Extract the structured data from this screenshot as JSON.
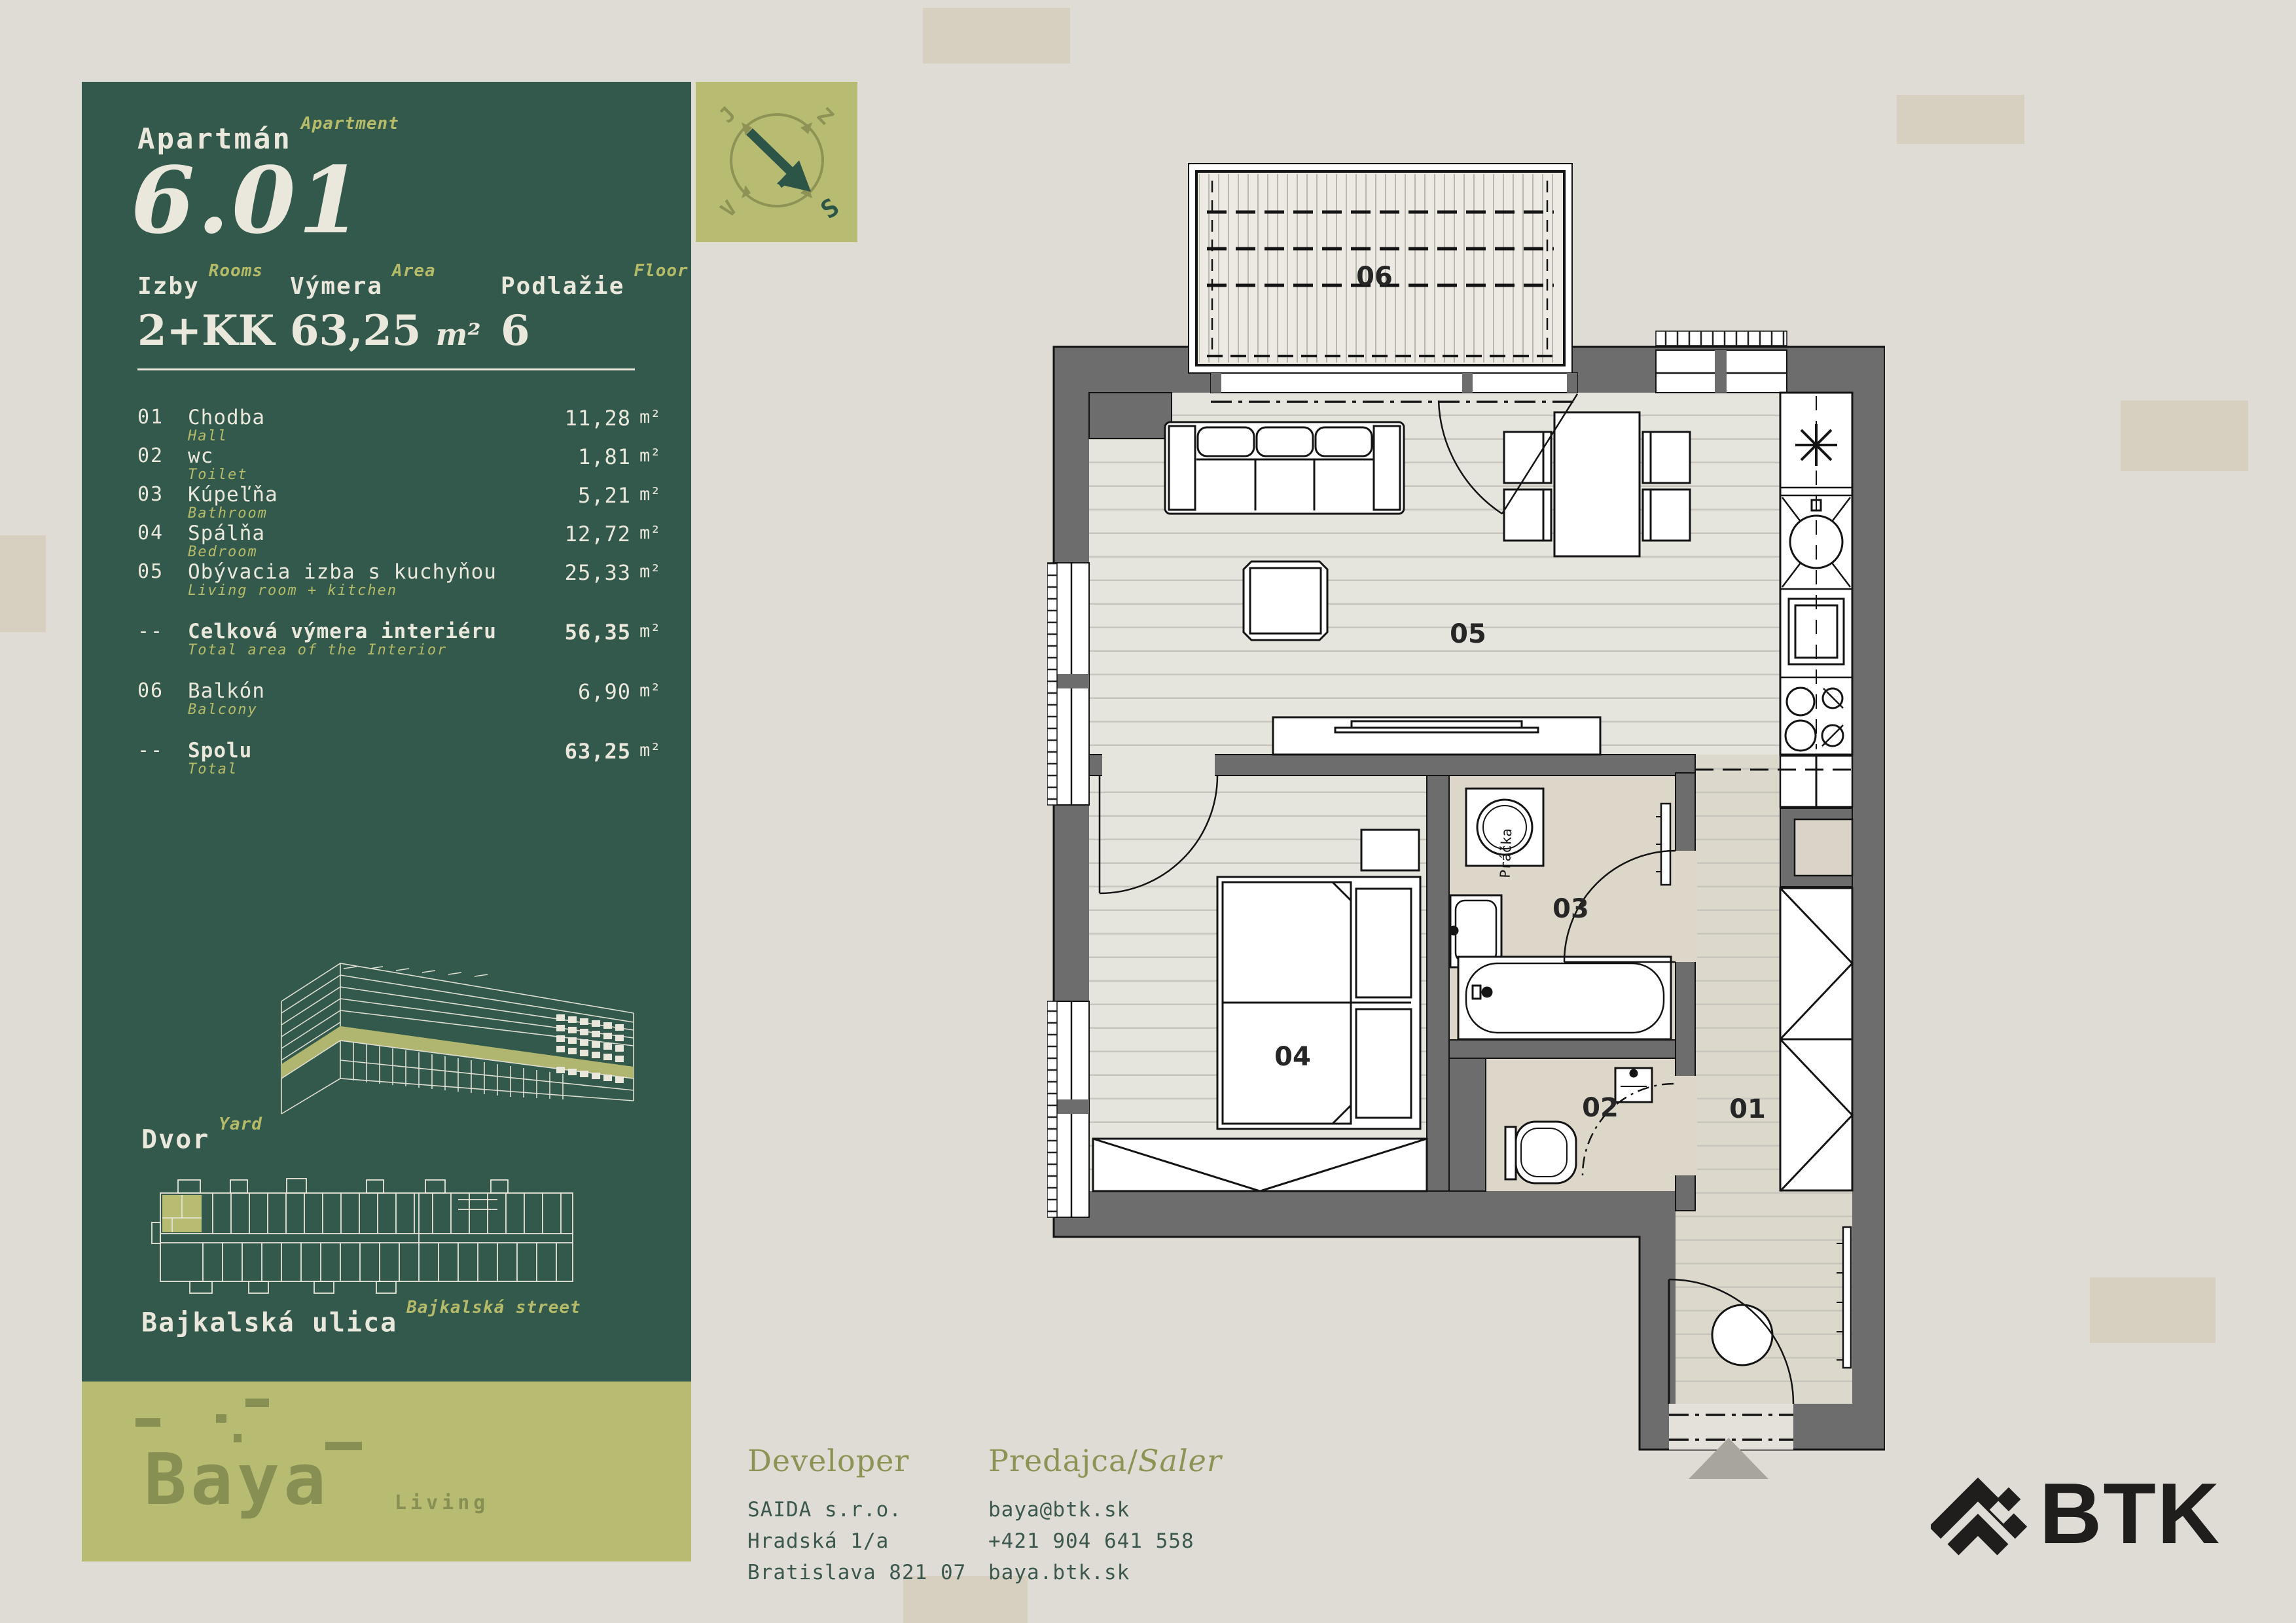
{
  "colors": {
    "green": "#32594b",
    "olive": "#b7bc72",
    "cream": "#eae7dc",
    "wall_gray": "#6d6d6d",
    "accent_text": "#b5bb69"
  },
  "panel": {
    "apartment_label_sk": "Apartmán",
    "apartment_label_en": "Apartment",
    "apartment_number": "6.01",
    "specs": [
      {
        "label_sk": "Izby",
        "label_en": "Rooms",
        "value": "2+KK",
        "unit": ""
      },
      {
        "label_sk": "Výmera",
        "label_en": "Area",
        "value": "63,25",
        "unit": "m²"
      },
      {
        "label_sk": "Podlažie",
        "label_en": "Floor",
        "value": "6",
        "unit": ""
      }
    ],
    "areas": [
      {
        "num": "01",
        "name": "Chodba",
        "sub": "Hall",
        "value": "11,28",
        "unit": "m²"
      },
      {
        "num": "02",
        "name": "wc",
        "sub": "Toilet",
        "value": "1,81",
        "unit": "m²"
      },
      {
        "num": "03",
        "name": "Kúpeľňa",
        "sub": "Bathroom",
        "value": "5,21",
        "unit": "m²"
      },
      {
        "num": "04",
        "name": "Spálňa",
        "sub": "Bedroom",
        "value": "12,72",
        "unit": "m²"
      },
      {
        "num": "05",
        "name": "Obývacia izba s kuchyňou",
        "sub": "Living room + kitchen",
        "value": "25,33",
        "unit": "m²"
      },
      {
        "num": "--",
        "name": "Celková výmera interiéru",
        "sub": "Total area of the Interior",
        "value": "56,35",
        "unit": "m²"
      },
      {
        "num": "06",
        "name": "Balkón",
        "sub": "Balcony",
        "value": "6,90",
        "unit": "m²"
      },
      {
        "num": "--",
        "name": "Spolu",
        "sub": "Total",
        "value": "63,25",
        "unit": "m²"
      }
    ],
    "yard_sk": "Dvor",
    "yard_en": "Yard",
    "street_sk": "Bajkalská ulica",
    "street_en": "Bajkalská street"
  },
  "compass": {
    "nw": "J",
    "ne": "Z",
    "sw": "V",
    "se": "S"
  },
  "brand": {
    "name": "Baya",
    "suffix": "Living"
  },
  "footer": {
    "developer": {
      "heading": "Developer",
      "line1": "SAIDA s.r.o.",
      "line2": "Hradská 1/a",
      "line3": "Bratislava 821 07"
    },
    "seller": {
      "heading_sk": "Predajca",
      "heading_sep": "/",
      "heading_en": "Saler",
      "line1": "baya@btk.sk",
      "line2": "+421 904 641 558",
      "line3": "baya.btk.sk"
    }
  },
  "partner_logo": {
    "text": "BTK"
  },
  "floorplan": {
    "labels": {
      "l01": "01",
      "l02": "02",
      "l03": "03",
      "l04": "04",
      "l05": "05",
      "l06": "06"
    },
    "washer_label": "Práčka"
  }
}
